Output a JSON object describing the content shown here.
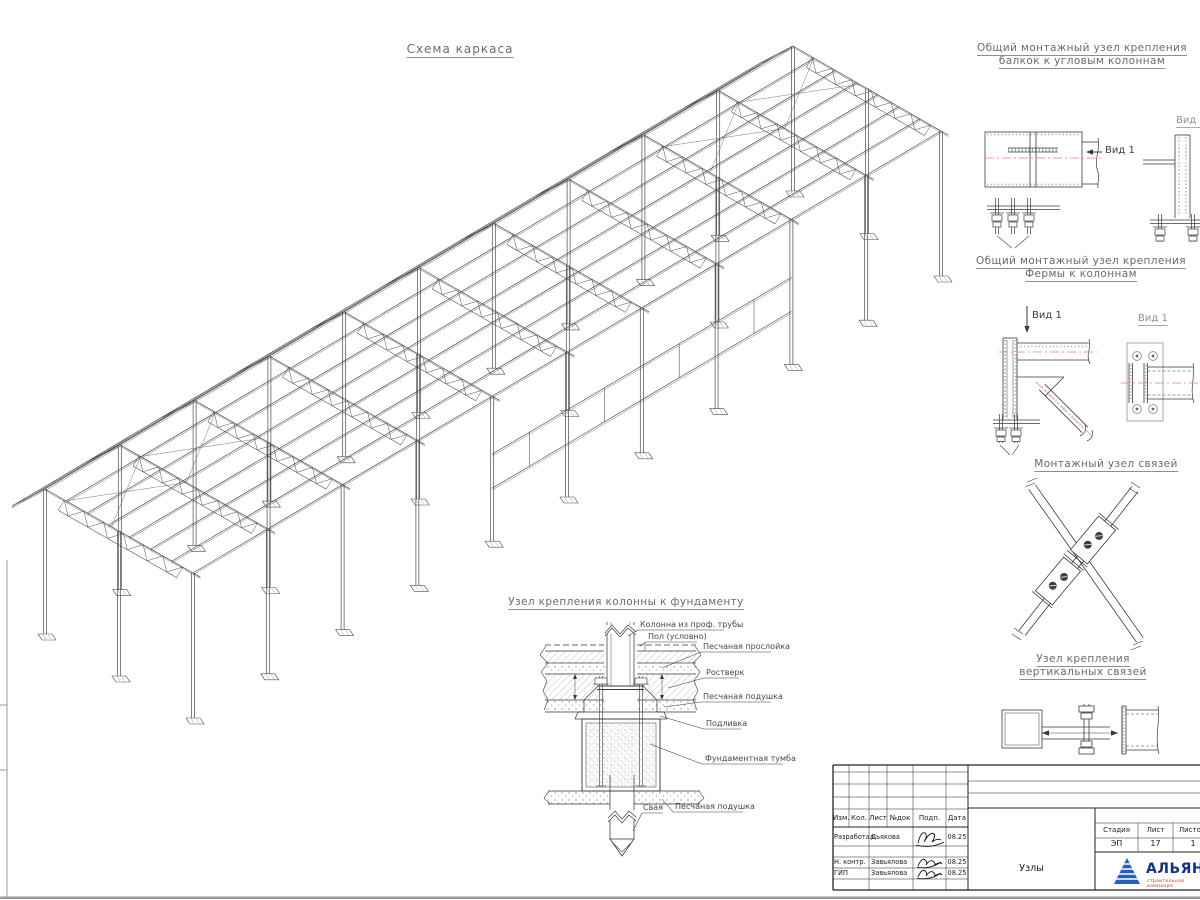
{
  "sheet": {
    "main_title": "Схема каркаса",
    "foundation": {
      "title": "Узел крепления колонны к фундаменту",
      "callout_column": "Колонна из проф. трубы",
      "callout_floor": "Пол (условно)",
      "callout_sand_layer": "Песчаная прослойка",
      "callout_grillage": "Ростверк",
      "callout_sand_cushion": "Песчаная подушка",
      "callout_grout": "Подливка",
      "callout_block": "Фундаментная тумба",
      "callout_pile": "Свая",
      "callout_sand_cushion2": "Песчаная подушка"
    },
    "details": {
      "corner": {
        "title1": "Общий монтажный узел крепления",
        "title2": "балкок к угловым колоннам",
        "view": "Вид 1",
        "view_side": "Вид 1"
      },
      "truss": {
        "title1": "Общий монтажный узел крепления",
        "title2": "Фермы к колоннам",
        "view": "Вид 1",
        "view_side": "Вид 1"
      },
      "brace": {
        "title": "Монтажный узел связей"
      },
      "vbrace": {
        "title1": "Узел крепления",
        "title2": "вертикальных связей"
      }
    }
  },
  "title_block": {
    "cols": [
      "Изм.",
      "Кол.",
      "Лист",
      "№док",
      "Подп.",
      "Дата"
    ],
    "rows": [
      {
        "role": "Разработал",
        "name": "Дьякова",
        "date": "08.25"
      },
      {
        "role": "Н. контр.",
        "name": "Завьялова",
        "date": "08.25"
      },
      {
        "role": "ГИП",
        "name": "Завьялова",
        "date": "08.25"
      }
    ],
    "doc_title": "Узлы",
    "stage_label": "Стадия",
    "stage": "ЭП",
    "sheet_label": "Лист",
    "sheet": "17",
    "sheets_label": "Листов",
    "sheets": "1",
    "company": "АЛЬЯНС",
    "company_sub": "строительная компания"
  }
}
